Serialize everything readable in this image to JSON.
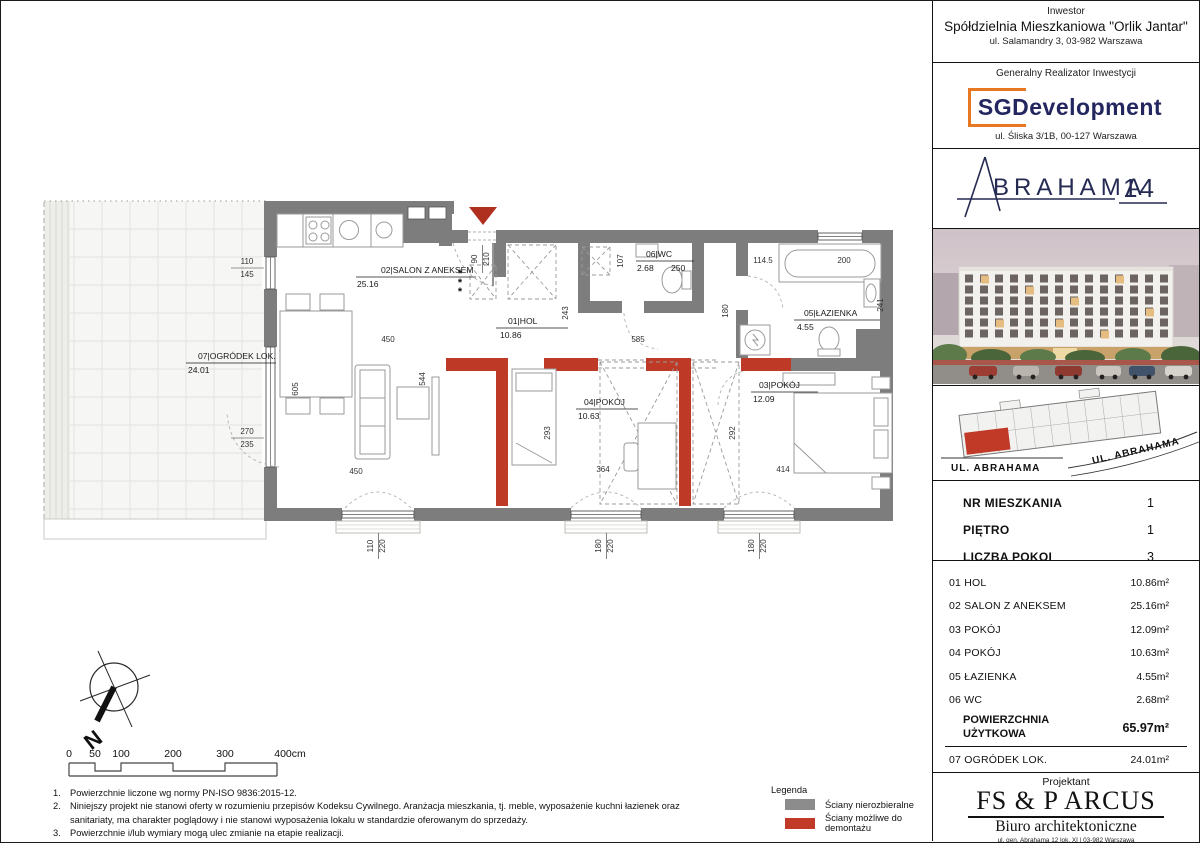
{
  "sidebar": {
    "investor": {
      "label": "Inwestor",
      "name": "Spółdzielnia Mieszkaniowa \"Orlik Jantar\"",
      "address": "ul. Salamandry 3, 03-982 Warszawa"
    },
    "developer": {
      "label": "Generalny Realizator Inwestycji",
      "logo_text": "SGDevelopment",
      "address": "ul. Śliska 3/1B, 00-127 Warszawa",
      "accent_color": "#e87722",
      "text_color": "#23265f"
    },
    "brand": {
      "a": "A",
      "name": "BRAHAMA",
      "number": "14",
      "color": "#252a52"
    },
    "siteplan": {
      "street_left": "UL. ABRAHAMA",
      "street_right": "UL. ABRAHAMA",
      "unit_color": "#c13a28"
    },
    "apartment": {
      "rows": [
        {
          "label": "NR MIESZKANIA",
          "value": "1"
        },
        {
          "label": "PIĘTRO",
          "value": "1"
        },
        {
          "label": "LICZBA POKOI",
          "value": "3"
        }
      ]
    },
    "rooms": [
      {
        "no": "01",
        "name": "HOL",
        "area": "10.86m²"
      },
      {
        "no": "02",
        "name": "SALON Z ANEKSEM",
        "area": "25.16m²"
      },
      {
        "no": "03",
        "name": "POKÓJ",
        "area": "12.09m²"
      },
      {
        "no": "04",
        "name": "POKÓJ",
        "area": "10.63m²"
      },
      {
        "no": "05",
        "name": "ŁAZIENKA",
        "area": "4.55m²"
      },
      {
        "no": "06",
        "name": "WC",
        "area": "2.68m²"
      }
    ],
    "total": {
      "label_line1": "POWIERZCHNIA",
      "label_line2": "UŻYTKOWA",
      "value": "65.97m²"
    },
    "garden": {
      "no": "07",
      "name": "OGRÓDEK LOK.",
      "area": "24.01m²"
    },
    "projektant": {
      "label": "Projektant",
      "name": "FS & P ARCUS",
      "subtitle": "Biuro architektoniczne",
      "address_line1": "ul. gen. Abrahama 12 lok. XI | 03-982 Warszawa",
      "address_line2": "www.fsparcus.com.pl | fsparcus@fsparcus.com.pl"
    }
  },
  "plan": {
    "wall_gray": "#7d7d7d",
    "wall_red": "#bf3a26",
    "star": "*",
    "labels": {
      "salon": {
        "title": "02|SALON Z ANEKSEM",
        "area": "25.16"
      },
      "hol": {
        "title": "01|HOL",
        "area": "10.86"
      },
      "wc": {
        "title": "06|WC",
        "area": "2.68",
        "width": "250"
      },
      "bath": {
        "title": "05|ŁAZIENKA",
        "area": "4.55"
      },
      "p3": {
        "title": "03|POKÓJ",
        "area": "12.09"
      },
      "p4": {
        "title": "04|POKÓJ",
        "area": "10.63"
      },
      "garden": {
        "title": "07|OGRÓDEK LOK.",
        "area": "24.01"
      }
    },
    "dims": {
      "salon_w": "450",
      "salon_bottom": "450",
      "salon_h": "605",
      "salon_inner": "544",
      "hol_w": "585",
      "hol_h": "243",
      "entry_w": "90",
      "entry_h": "210",
      "wc_h": "107",
      "bath_corridor": "114.5",
      "tub": "200",
      "bath_h": "241",
      "bath_door": "180",
      "p4_h": "293",
      "p4_w": "364",
      "p3_h": "292",
      "p3_w": "414"
    },
    "windows": {
      "lw1_a": "110",
      "lw1_b": "145",
      "lw2_a": "270",
      "lw2_b": "235",
      "bw1_a": "110",
      "bw1_b": "220",
      "bw2_a": "180",
      "bw2_b": "220",
      "bw3_a": "180",
      "bw3_b": "220"
    }
  },
  "compass": {
    "label": "N"
  },
  "scalebar": {
    "t0": "0",
    "t50": "50",
    "t100": "100",
    "t200": "200",
    "t300": "300",
    "t400": "400cm"
  },
  "notes": {
    "items": [
      {
        "num": "1.",
        "text": "Powierzchnie liczone wg normy PN-ISO 9836:2015-12."
      },
      {
        "num": "2.",
        "text": "Niniejszy projekt nie stanowi oferty w rozumieniu przepisów Kodeksu Cywilnego. Aranżacja mieszkania, tj. meble, wyposażenie  kuchni łazienek oraz sanitariaty, ma charakter poglądowy i nie stanowi wyposażenia lokalu w standardzie oferowanym do sprzedaży."
      },
      {
        "num": "3.",
        "text": "Powierzchnie i/lub wymiary mogą ulec zmianie na etapie realizacji."
      },
      {
        "num": "4.",
        "text": "Wyjście na tarasy/loggie/balkony - możliwa różnica poziomów."
      }
    ]
  },
  "legend": {
    "title": "Legenda",
    "items": [
      {
        "label": "Ściany nierozbieralne",
        "color": "#8c8c8c"
      },
      {
        "label": "Ściany możliwe do demontażu",
        "color": "#c13a28"
      }
    ]
  }
}
